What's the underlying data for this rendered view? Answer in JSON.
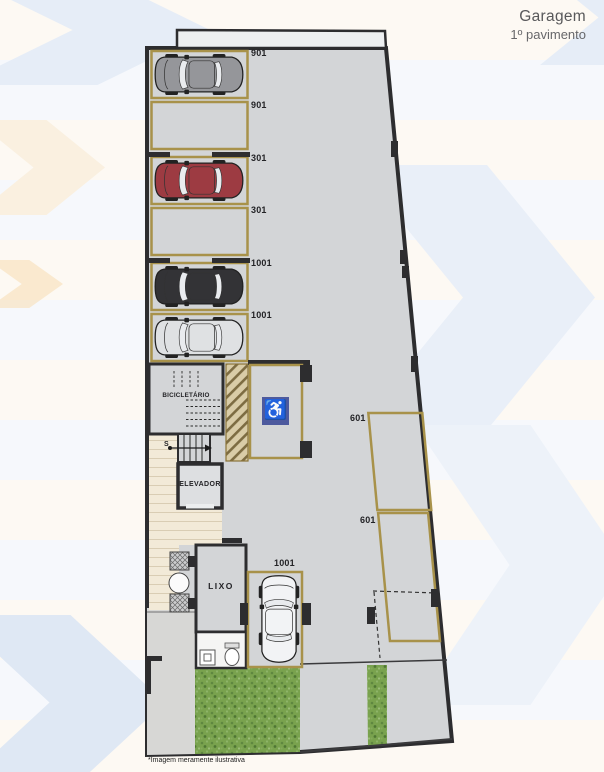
{
  "header": {
    "title": "Garagem",
    "subtitle": "1º pavimento"
  },
  "footnote": "*Imagem meramente ilustrativa",
  "floorplan": {
    "left_column_spots": [
      {
        "label": "901",
        "occupied": true,
        "car": "gray-suv",
        "car_hex": "#95969a"
      },
      {
        "label": "901",
        "occupied": false
      },
      {
        "label": "301",
        "occupied": true,
        "car": "red-sedan",
        "car_hex": "#9d3b42"
      },
      {
        "label": "301",
        "occupied": false
      },
      {
        "label": "1001",
        "occupied": true,
        "car": "black-suv",
        "car_hex": "#333336"
      },
      {
        "label": "1001",
        "occupied": true,
        "car": "silver-sedan",
        "car_hex": "#dfe1e3"
      }
    ],
    "right_spots": [
      {
        "label": "601",
        "occupied": false
      },
      {
        "label": "601",
        "occupied": false
      }
    ],
    "bottom_spot": {
      "label": "1001",
      "occupied": true,
      "car": "white-hatch",
      "car_hex": "#f2f3f5"
    },
    "rooms": {
      "bicicletario": "BICICLETÁRIO",
      "elevador": "ELEVADOR",
      "lixo": "LIXO",
      "stairs_label": "S"
    },
    "accessible_spot": {
      "icon": "wheelchair-icon",
      "symbol": "♿",
      "bg_hex": "#4d5a9e"
    },
    "colors": {
      "floor": "#d3d5d7",
      "wall": "#2d2d2f",
      "spot_outline": "#a8924a",
      "grass": "#79a24e",
      "walkway": "#f2ead8",
      "accent_blue": "#e9eff8",
      "accent_cream": "#fcf7ef"
    }
  }
}
